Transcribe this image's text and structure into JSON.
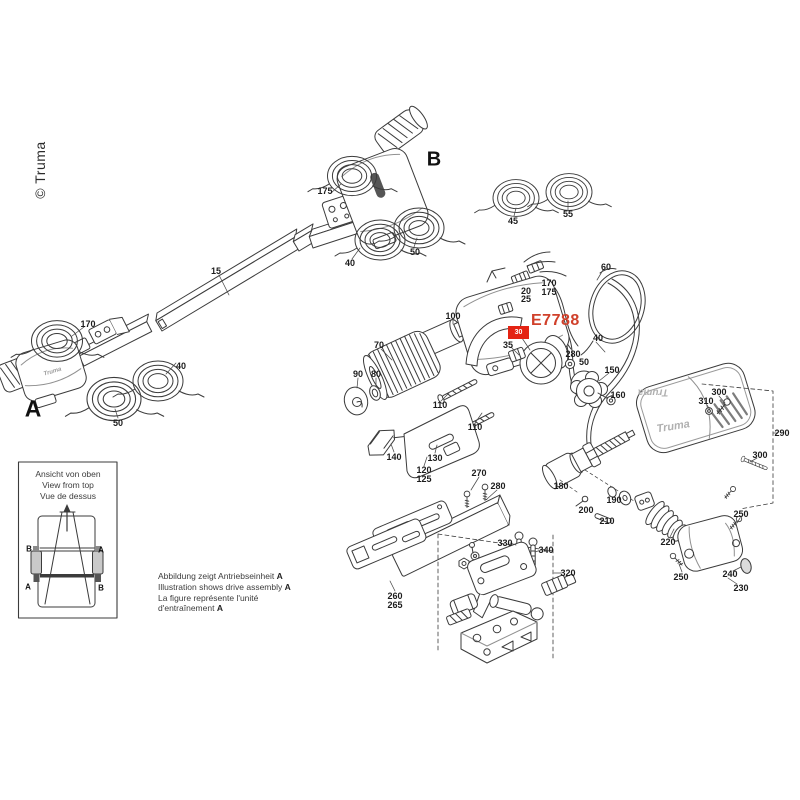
{
  "page": {
    "copyright": "© Truma",
    "colors": {
      "line": "#3b3b3b",
      "accent_red": "#d0402a",
      "marker_red": "#e42313"
    }
  },
  "highlight": {
    "part_code": "E7788",
    "marker_label": "30"
  },
  "assembly_letters": [
    {
      "text": "A",
      "x": 33,
      "y": 409,
      "size": 23
    },
    {
      "text": "B",
      "x": 434,
      "y": 160,
      "size": 20
    }
  ],
  "cover": {
    "logo_top": "Truma",
    "logo_front": "Truma"
  },
  "motor_a": {
    "logo": "Truma"
  },
  "part_labels": [
    {
      "text": "175",
      "x": 325,
      "y": 191
    },
    {
      "text": "15",
      "x": 216,
      "y": 271
    },
    {
      "text": "40",
      "x": 350,
      "y": 263
    },
    {
      "text": "50",
      "x": 415,
      "y": 252
    },
    {
      "text": "45",
      "x": 513,
      "y": 221
    },
    {
      "text": "55",
      "x": 568,
      "y": 214
    },
    {
      "text": "170",
      "x": 88,
      "y": 324
    },
    {
      "text": "40",
      "x": 181,
      "y": 366
    },
    {
      "text": "50",
      "x": 118,
      "y": 423
    },
    {
      "text": "60",
      "x": 606,
      "y": 267
    },
    {
      "text": "170",
      "x": 549,
      "y": 283
    },
    {
      "text": "175",
      "x": 549,
      "y": 292
    },
    {
      "text": "20",
      "x": 526,
      "y": 291
    },
    {
      "text": "25",
      "x": 526,
      "y": 299
    },
    {
      "text": "100",
      "x": 453,
      "y": 316
    },
    {
      "text": "70",
      "x": 379,
      "y": 345
    },
    {
      "text": "90",
      "x": 358,
      "y": 374
    },
    {
      "text": "80",
      "x": 376,
      "y": 374
    },
    {
      "text": "35",
      "x": 508,
      "y": 345
    },
    {
      "text": "40",
      "x": 598,
      "y": 338
    },
    {
      "text": "280",
      "x": 573,
      "y": 354
    },
    {
      "text": "50",
      "x": 584,
      "y": 362
    },
    {
      "text": "150",
      "x": 612,
      "y": 370
    },
    {
      "text": "160",
      "x": 618,
      "y": 395
    },
    {
      "text": "110",
      "x": 440,
      "y": 405
    },
    {
      "text": "110",
      "x": 475,
      "y": 427
    },
    {
      "text": "140",
      "x": 394,
      "y": 457
    },
    {
      "text": "130",
      "x": 435,
      "y": 458
    },
    {
      "text": "120",
      "x": 424,
      "y": 470
    },
    {
      "text": "125",
      "x": 424,
      "y": 479
    },
    {
      "text": "270",
      "x": 479,
      "y": 473
    },
    {
      "text": "280",
      "x": 498,
      "y": 486
    },
    {
      "text": "180",
      "x": 561,
      "y": 486
    },
    {
      "text": "200",
      "x": 586,
      "y": 510
    },
    {
      "text": "190",
      "x": 614,
      "y": 500
    },
    {
      "text": "210",
      "x": 607,
      "y": 521
    },
    {
      "text": "220",
      "x": 668,
      "y": 542
    },
    {
      "text": "300",
      "x": 719,
      "y": 392
    },
    {
      "text": "310",
      "x": 706,
      "y": 401
    },
    {
      "text": "290",
      "x": 782,
      "y": 433
    },
    {
      "text": "300",
      "x": 760,
      "y": 455
    },
    {
      "text": "250",
      "x": 741,
      "y": 514
    },
    {
      "text": "250",
      "x": 681,
      "y": 577
    },
    {
      "text": "240",
      "x": 730,
      "y": 574
    },
    {
      "text": "230",
      "x": 741,
      "y": 588
    },
    {
      "text": "330",
      "x": 505,
      "y": 543
    },
    {
      "text": "340",
      "x": 546,
      "y": 550
    },
    {
      "text": "320",
      "x": 568,
      "y": 573
    },
    {
      "text": "260",
      "x": 395,
      "y": 596
    },
    {
      "text": "265",
      "x": 395,
      "y": 605
    }
  ],
  "inset": {
    "titles": [
      "Ansicht von oben",
      "View from top",
      "Vue de dessus"
    ],
    "corner_labels": [
      {
        "text": "B",
        "x": 29,
        "y": 549
      },
      {
        "text": "A",
        "x": 101,
        "y": 550
      },
      {
        "text": "A",
        "x": 28,
        "y": 587
      },
      {
        "text": "B",
        "x": 101,
        "y": 588
      }
    ]
  },
  "caption": {
    "lines": [
      {
        "text": "Abbildung zeigt Antriebseinheit ",
        "bold": "A"
      },
      {
        "text": "Illustration shows drive assembly ",
        "bold": "A"
      },
      {
        "text": "La figure représente l'unité",
        "bold": ""
      },
      {
        "text": "d'entraînement ",
        "bold": "A"
      }
    ]
  }
}
